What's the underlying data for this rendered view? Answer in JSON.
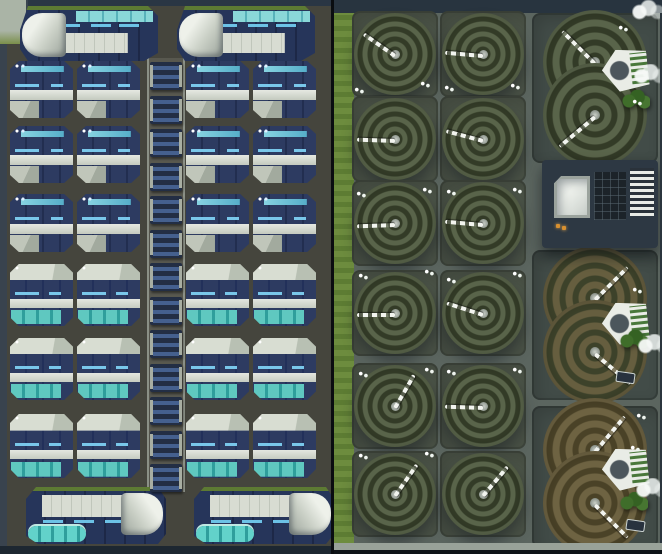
{
  "scene": {
    "left_panel_label": "residential district",
    "right_panel_label": "agriculture district"
  },
  "palette": {
    "left_ground": "#45453d",
    "right_ground": "#5b655f",
    "navy_roof": "#243252",
    "cyan_strip": "#79c7ea",
    "teal_glass": "#5fc8c0",
    "white_band": "#e6e9e2",
    "grass": "#6d8c3e",
    "ring_green_dark": "#333b27",
    "ring_green_light": "#59644a",
    "ring_mixed_dark": "#3d422a",
    "ring_mixed_light": "#665e3f",
    "ring_brown_dark": "#4a4227",
    "ring_brown_light": "#6e6342"
  },
  "left_panel": {
    "large_buildings_top": [
      {
        "x": 20,
        "y": 6,
        "w": 138,
        "h": 55
      },
      {
        "x": 177,
        "y": 6,
        "w": 138,
        "h": 55
      }
    ],
    "large_buildings_bottom": [
      {
        "x": 26,
        "y": 487,
        "w": 140,
        "h": 57
      },
      {
        "x": 194,
        "y": 487,
        "w": 140,
        "h": 57
      }
    ],
    "residence_cols": [
      10,
      77,
      186,
      253
    ],
    "residence_width": 63,
    "residence_rows": [
      {
        "y": 61,
        "type": 1,
        "h": 57
      },
      {
        "y": 126,
        "type": 1,
        "h": 57
      },
      {
        "y": 194,
        "type": 1,
        "h": 58
      },
      {
        "y": 264,
        "type": 2,
        "h": 62
      },
      {
        "y": 338,
        "type": 2,
        "h": 62
      },
      {
        "y": 414,
        "type": 2,
        "h": 64
      }
    ],
    "spine_modules": {
      "x": 150,
      "y_start": 62,
      "step": 33.5,
      "count": 13
    }
  },
  "right_panel": {
    "circle_plot_cols": [
      18,
      106
    ],
    "circle_plot_rows": [
      11,
      96,
      180,
      270,
      363,
      451
    ],
    "arm_angles": [
      [
        215,
        185
      ],
      [
        182,
        195
      ],
      [
        178,
        185
      ],
      [
        180,
        198
      ],
      [
        300,
        182
      ],
      [
        305,
        310
      ]
    ],
    "arm_length": 38,
    "double_fields": [
      {
        "x": 198,
        "y": 13,
        "w": 126,
        "h": 150,
        "lobe_cy": [
          49,
          102
        ],
        "tint": "green",
        "arms": [
          225,
          140
        ],
        "harvester": {
          "x": 70,
          "y": 36
        }
      },
      {
        "x": 198,
        "y": 250,
        "w": 126,
        "h": 150,
        "lobe_cy": [
          48,
          102
        ],
        "tint": "mixed",
        "arms": [
          315,
          40
        ],
        "harvester": {
          "x": 70,
          "y": 52
        }
      },
      {
        "x": 198,
        "y": 406,
        "w": 126,
        "h": 142,
        "lobe_cy": [
          44,
          97
        ],
        "tint": "brown",
        "arms": [
          310,
          45
        ],
        "harvester": {
          "x": 70,
          "y": 42
        }
      }
    ],
    "lobe_cx": 63,
    "lobe_arm_length": 46,
    "factory": {
      "x": 208,
      "y": 160,
      "w": 116,
      "h": 88,
      "atrium": {
        "x": 12,
        "y": 16,
        "w": 36,
        "h": 42
      },
      "core": {
        "x": 52,
        "y": 12,
        "w": 32,
        "h": 48
      },
      "slats": {
        "x": 88,
        "y": 8,
        "w": 24,
        "h": 48
      },
      "lights": [
        [
          14,
          64
        ],
        [
          20,
          66
        ]
      ]
    },
    "bushes": [
      [
        288,
        90
      ],
      [
        286,
        330
      ],
      [
        286,
        492
      ]
    ],
    "steam": [
      [
        300,
        64
      ],
      [
        304,
        334
      ],
      [
        302,
        478
      ],
      [
        298,
        0
      ]
    ],
    "markers": [
      [
        20,
        86
      ],
      [
        86,
        80
      ],
      [
        110,
        84
      ],
      [
        176,
        82
      ],
      [
        284,
        24
      ],
      [
        298,
        98
      ],
      [
        22,
        190
      ],
      [
        88,
        186
      ],
      [
        112,
        188
      ],
      [
        178,
        186
      ],
      [
        24,
        272
      ],
      [
        90,
        268
      ],
      [
        112,
        276
      ],
      [
        178,
        270
      ],
      [
        298,
        286
      ],
      [
        24,
        370
      ],
      [
        90,
        366
      ],
      [
        112,
        368
      ],
      [
        178,
        366
      ],
      [
        302,
        412
      ],
      [
        24,
        452
      ],
      [
        90,
        450
      ],
      [
        296,
        444
      ],
      [
        300,
        520
      ]
    ],
    "trucks": [
      [
        282,
        372
      ],
      [
        292,
        520
      ]
    ]
  }
}
